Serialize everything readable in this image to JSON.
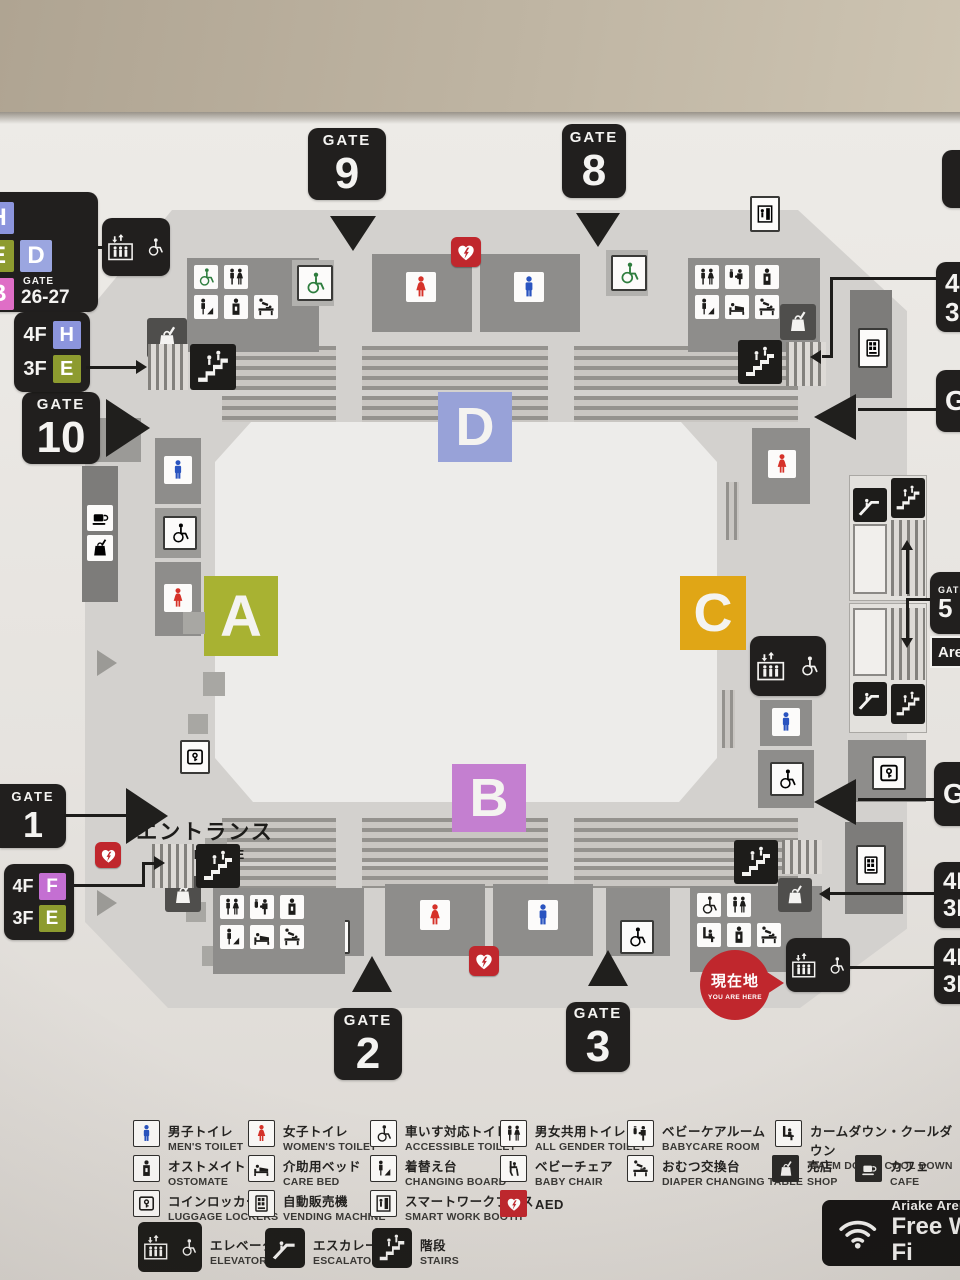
{
  "gates": {
    "g9": {
      "word": "GATE",
      "num": "9"
    },
    "g8": {
      "word": "GATE",
      "num": "8"
    },
    "g10": {
      "word": "GATE",
      "num": "10"
    },
    "g1": {
      "word": "GATE",
      "num": "1"
    },
    "g2": {
      "word": "GATE",
      "num": "2"
    },
    "g3": {
      "word": "GATE",
      "num": "3"
    }
  },
  "stand_signs": {
    "top_left": {
      "h": "H",
      "e": "E",
      "d": "D",
      "b": "B",
      "gate_word": "GATE",
      "gate_num": "26-27"
    },
    "left_upper": {
      "f4": "4F",
      "l4": "H",
      "f3": "3F",
      "l3": "E"
    },
    "left_lower": {
      "f4": "4F",
      "l4": "F",
      "f3": "3F",
      "l3": "E"
    }
  },
  "edge_signs": {
    "ne_floor": {
      "r1": "4F",
      "r2": "3F"
    },
    "ne_gate": {
      "word": "GATE"
    },
    "gate5": {
      "word": "GATE",
      "num": "5",
      "sub": "Arena"
    },
    "e_gate": {
      "word": "GATE"
    },
    "se_floor1": {
      "r1": "4F",
      "r2": "3F"
    },
    "se_floor2": {
      "r1": "4F",
      "r2": "3F"
    }
  },
  "sections": {
    "a": "A",
    "b": "B",
    "c": "C",
    "d": "D"
  },
  "entrance": {
    "jp": "エントランス",
    "en": "ENTRANCE"
  },
  "you_are_here": {
    "jp": "現在地",
    "en": "YOU ARE HERE"
  },
  "wifi": {
    "line1": "Ariake Arena",
    "line2": "Free Wi-Fi"
  },
  "legend": {
    "men": {
      "jp": "男子トイレ",
      "en": "MEN'S TOILET"
    },
    "women": {
      "jp": "女子トイレ",
      "en": "WOMEN'S TOILET"
    },
    "accessible": {
      "jp": "車いす対応トイレ",
      "en": "ACCESSIBLE TOILET"
    },
    "allgender": {
      "jp": "男女共用トイレ",
      "en": "ALL GENDER TOILET"
    },
    "babycare": {
      "jp": "ベビーケアルーム",
      "en": "BABYCARE ROOM"
    },
    "calmdown": {
      "jp": "カームダウン・クールダウン",
      "en": "CALM DOWN, COOL DOWN"
    },
    "ostomate": {
      "jp": "オストメイト",
      "en": "OSTOMATE"
    },
    "carebed": {
      "jp": "介助用ベッド",
      "en": "CARE BED"
    },
    "changingboard": {
      "jp": "着替え台",
      "en": "CHANGING BOARD"
    },
    "babychair": {
      "jp": "ベビーチェア",
      "en": "BABY CHAIR"
    },
    "diaper": {
      "jp": "おむつ交換台",
      "en": "DIAPER CHANGING TABLE"
    },
    "shop": {
      "jp": "売店",
      "en": "SHOP"
    },
    "cafe": {
      "jp": "カフェ",
      "en": "CAFE"
    },
    "locker": {
      "jp": "コインロッカー",
      "en": "LUGGAGE LOCKERS"
    },
    "vending": {
      "jp": "自動販売機",
      "en": "VENDING MACHINE"
    },
    "smartbooth": {
      "jp": "スマートワークブース",
      "en": "SMART WORK BOOTH"
    },
    "aed": {
      "en": "AED"
    },
    "elevator": {
      "jp": "エレベーター",
      "en": "ELEVATOR"
    },
    "escalator": {
      "jp": "エスカレーター",
      "en": "ESCALATOR"
    },
    "stairs": {
      "jp": "階段",
      "en": "STAIRS"
    }
  },
  "colors": {
    "section_a": "#a8b232",
    "section_b": "#c47fd0",
    "section_c": "#e0a616",
    "section_d": "#98a2d8",
    "letter_h": "#8c95dd",
    "letter_e": "#8d9b2f",
    "letter_d": "#9ba6e0",
    "letter_b": "#df6ec6",
    "letter_f": "#c46fd2",
    "men_blue": "#2a54c0",
    "women_red": "#d63229",
    "access_green": "#2e7d3e",
    "aed_red": "#c0272d",
    "here_red": "#c0272d",
    "sign_black": "#211f1e"
  }
}
